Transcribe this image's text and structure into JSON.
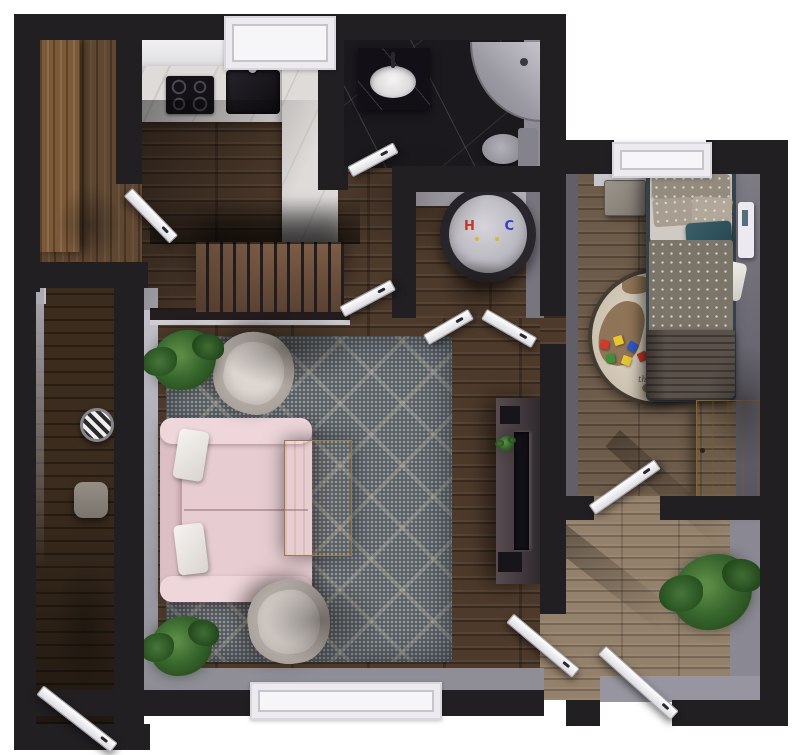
{
  "scene": {
    "type": "apartment-floor-plan-3d-render",
    "view": "top-down"
  },
  "labels": {
    "heater_hot": "H",
    "heater_cold": "C",
    "bedroom_rug_text": "the World"
  },
  "stairs": {
    "tread_count": 11
  },
  "toy_blocks": {
    "colors": [
      "#d03a2e",
      "#e8c62e",
      "#2e58c8",
      "#3f8f3a",
      "#e8c62e",
      "#d03a2e"
    ]
  },
  "theme": {
    "colors": {
      "wall": "#211f22",
      "wallLit": "#b6b4bc",
      "floorDark": "#4d3a2b",
      "floorBedroom": "#6e5c4a",
      "floorCorridor": "#94816b",
      "deck": "#3b2c1e",
      "marbleWhite": "#dedbd9",
      "marbleBlack": "#1b191d",
      "rugMain": "#59616b",
      "roundRug": "#cbc0ae",
      "mapBrown": "#8a6c4e",
      "sofa": "#e7cdd1",
      "tableWood": "#e2bd82",
      "wardrobeWood": "#cf9a44",
      "plantGreen": "#39682e",
      "heaterTop": "#d6d4da",
      "hot": "#c0392b",
      "cold": "#2f3ec7",
      "tv": "#121016",
      "console": "#2e282c",
      "doorWhite": "#dcdbe1",
      "windowWhite": "#f6f5f7"
    }
  }
}
